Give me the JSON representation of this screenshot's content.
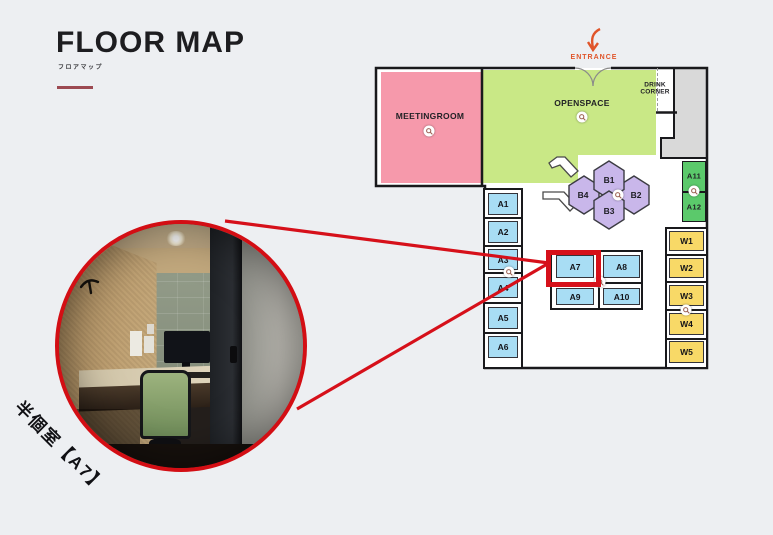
{
  "header": {
    "title": "FLOOR MAP",
    "subtitle": "フロアマップ"
  },
  "map": {
    "entrance_label": "ENTRANCE",
    "meetingroom_label": "MEETINGROOM",
    "openspace_label": "OPENSPACE",
    "drink_corner_line1": "DRINK",
    "drink_corner_line2": "CORNER",
    "hex_booths": [
      "B1",
      "B2",
      "B3",
      "B4"
    ],
    "a_column": [
      "A1",
      "A2",
      "A3",
      "A4",
      "A5",
      "A6"
    ],
    "center_cluster": [
      "A7",
      "A8",
      "A9",
      "A10"
    ],
    "green_pair": [
      "A11",
      "A12"
    ],
    "w_column": [
      "W1",
      "W2",
      "W3",
      "W4",
      "W5"
    ],
    "highlighted_booth": "A7"
  },
  "callout": {
    "label": "半個室【A7】"
  },
  "colors": {
    "accent_red": "#d6101a",
    "entrance_orange": "#e0552a",
    "meetingroom_pink": "#f699ab",
    "openspace_green": "#c9e886",
    "booth_blue": "#a8ddf4",
    "hex_purple": "#c9b7ea",
    "pair_green": "#5bc96b",
    "w_yellow": "#f8d967",
    "utility_gray": "#d9d9d9"
  }
}
